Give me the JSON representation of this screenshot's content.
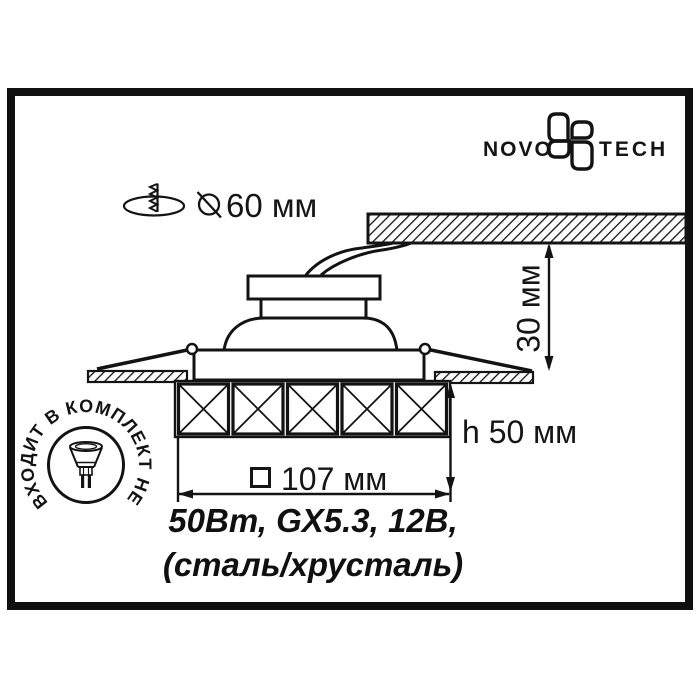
{
  "brand": {
    "left": "NOVO",
    "right": "TECH",
    "flower_icon": "novotech-flower-icon"
  },
  "cutout": {
    "label": "60 мм",
    "icons": [
      "mount-hole-screw-icon",
      "diameter-icon"
    ]
  },
  "dimensions": {
    "depth": "30 мм",
    "height": "h 50 мм",
    "width": "107 мм",
    "width_symbol": "square-symbol"
  },
  "stamp": {
    "circular_text": "ВХОДИТ В КОМПЛЕКТ НЕ",
    "icon": "halogen-lamp-icon"
  },
  "specs": {
    "line1": "50Вт, GX5.3, 12В,",
    "line2": "(сталь/хрусталь)"
  }
}
